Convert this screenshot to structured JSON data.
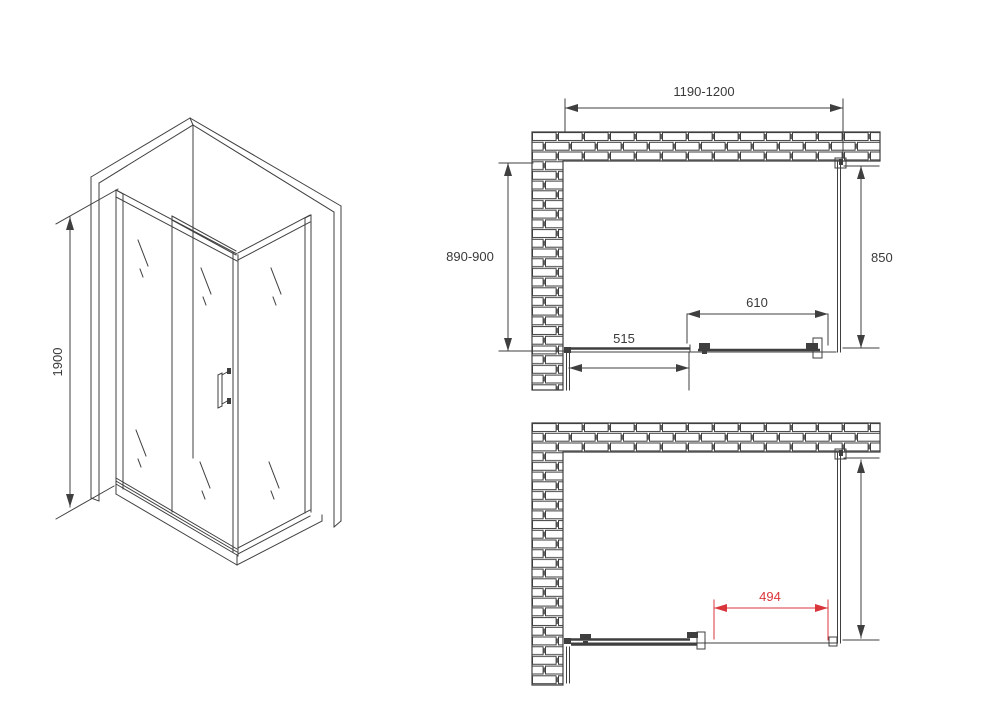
{
  "drawing": {
    "title": "shower-enclosure-technical-drawing",
    "colors": {
      "line": "#3f3f3f",
      "dimension_red": "#d9363c",
      "background": "#ffffff"
    },
    "iso": {
      "height": "1900"
    },
    "top_plan": {
      "overall_width": "1190-1200",
      "overall_depth": "890-900",
      "side_panel_width": "850",
      "door_width": "610",
      "fixed_panel_width": "515"
    },
    "bottom_plan": {
      "door_opening_width": "494"
    }
  }
}
